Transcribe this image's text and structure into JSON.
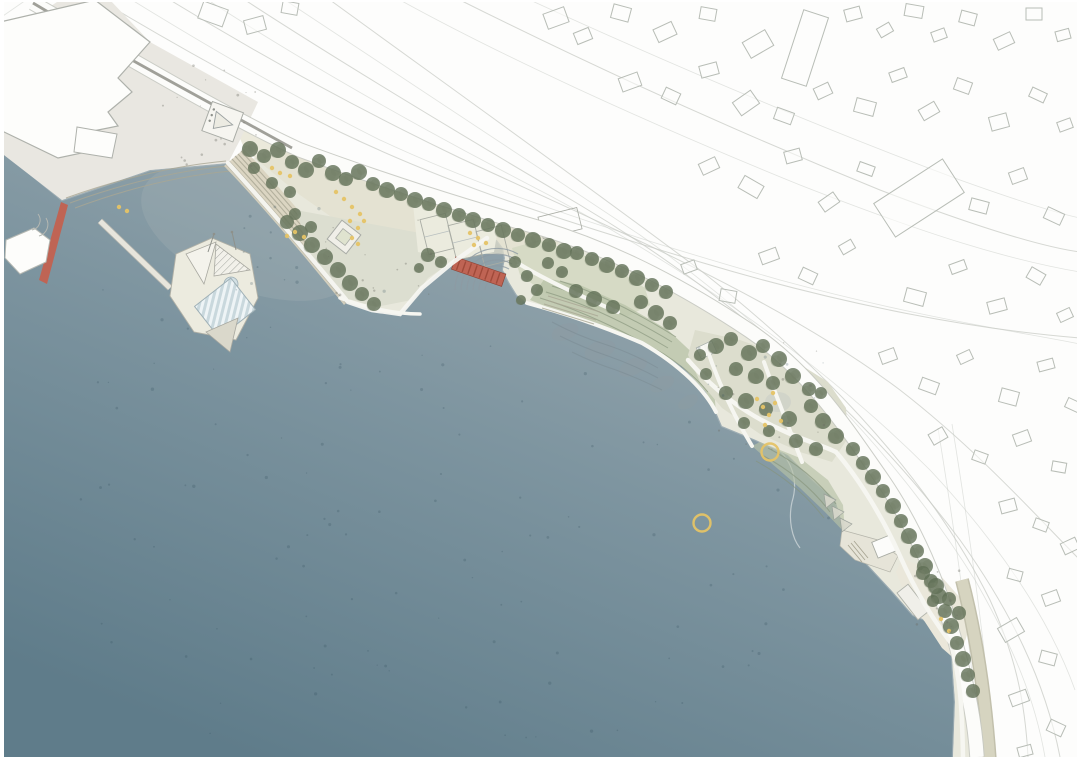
{
  "meta": {
    "type": "landscape masterplan site plan, aerial top-down rendering",
    "visible_text": "none",
    "scene": "harbor waterfront park with basin, floating harbor bath, red pedestrian pier and bridge, shoreline parks and existing town context"
  },
  "colors": {
    "water_light": "#9dabb1",
    "water_mid": "#7e95a0",
    "water_deep": "#5f7c8a",
    "land_base": "#e8e8dc",
    "wharf": "#e9e7e1",
    "promenade_tan": "#e2dfcd",
    "plaza": "#dcded0",
    "lawn": "#d6dac5",
    "slope_green": "#b7c1a6",
    "steps_tan": "#d9d3bf",
    "steps_line": "#a9a694",
    "tree_dark": "#5f6e55",
    "tree_mid": "#74816a",
    "sand": "#eae7da",
    "street_tan": "#cfcdb8",
    "path_white": "#f6f6f1",
    "road_white": "#fcfcfa",
    "road_edge": "#c6c9c2",
    "dark_road_line": "#96968e",
    "line_gray": "#c8cbc5",
    "building_stroke": "#b8bdb6",
    "accent_red": "#bf6454",
    "accent_red_dark": "#a04a3a",
    "accent_yellow": "#e5c366",
    "wetland": "#8e9ba2",
    "pool_blue": "#d3e0e4",
    "deck_white": "#ecebdf"
  },
  "legend_semantics": {
    "water_area": "harbor / sea basin",
    "red_strip_left": "red pier gangway at wharf",
    "red_strip_center": "red pedestrian bridge over inlet channel",
    "green_blobs": "tree canopies",
    "yellow_rings": "swimming floats in water",
    "yellow_dots": "playground / activity markings",
    "outlined_rectangles": "existing context building footprints",
    "striped_rectangle": "floating harbor bath pool deck",
    "hatched_lines": "terraced steps to water"
  },
  "map": {
    "swim_rings": [
      [
        770,
        452
      ],
      [
        702,
        523
      ]
    ],
    "swim_ring_radius": 8.5,
    "trees": [
      [
        250,
        149,
        8
      ],
      [
        264,
        156,
        7
      ],
      [
        278,
        150,
        8
      ],
      [
        292,
        162,
        7
      ],
      [
        306,
        170,
        8
      ],
      [
        319,
        161,
        7
      ],
      [
        333,
        173,
        8
      ],
      [
        346,
        179,
        7
      ],
      [
        359,
        172,
        8
      ],
      [
        373,
        184,
        7
      ],
      [
        387,
        190,
        8
      ],
      [
        401,
        194,
        7
      ],
      [
        415,
        200,
        8
      ],
      [
        429,
        204,
        7
      ],
      [
        444,
        210,
        8
      ],
      [
        459,
        215,
        7
      ],
      [
        473,
        220,
        8
      ],
      [
        488,
        225,
        7
      ],
      [
        503,
        230,
        8
      ],
      [
        518,
        235,
        7
      ],
      [
        533,
        240,
        8
      ],
      [
        549,
        245,
        7
      ],
      [
        564,
        251,
        8
      ],
      [
        272,
        183,
        6
      ],
      [
        254,
        168,
        6
      ],
      [
        290,
        192,
        6
      ],
      [
        287,
        222,
        7
      ],
      [
        300,
        233,
        8
      ],
      [
        312,
        245,
        8
      ],
      [
        325,
        257,
        8
      ],
      [
        338,
        270,
        8
      ],
      [
        350,
        283,
        8
      ],
      [
        362,
        294,
        7
      ],
      [
        374,
        304,
        7
      ],
      [
        295,
        214,
        6
      ],
      [
        311,
        227,
        6
      ],
      [
        428,
        255,
        7
      ],
      [
        441,
        262,
        6
      ],
      [
        419,
        268,
        5
      ],
      [
        515,
        262,
        6
      ],
      [
        527,
        276,
        6
      ],
      [
        537,
        290,
        6
      ],
      [
        521,
        300,
        5
      ],
      [
        577,
        253,
        7
      ],
      [
        592,
        259,
        7
      ],
      [
        607,
        265,
        8
      ],
      [
        622,
        271,
        7
      ],
      [
        637,
        278,
        8
      ],
      [
        652,
        285,
        7
      ],
      [
        666,
        292,
        7
      ],
      [
        576,
        291,
        7
      ],
      [
        594,
        299,
        8
      ],
      [
        613,
        307,
        7
      ],
      [
        562,
        272,
        6
      ],
      [
        548,
        263,
        6
      ],
      [
        641,
        302,
        7
      ],
      [
        656,
        313,
        8
      ],
      [
        670,
        323,
        7
      ],
      [
        716,
        346,
        8
      ],
      [
        731,
        339,
        7
      ],
      [
        749,
        353,
        8
      ],
      [
        763,
        346,
        7
      ],
      [
        779,
        359,
        8
      ],
      [
        736,
        369,
        7
      ],
      [
        756,
        376,
        8
      ],
      [
        773,
        383,
        7
      ],
      [
        793,
        376,
        8
      ],
      [
        809,
        389,
        7
      ],
      [
        726,
        393,
        7
      ],
      [
        746,
        401,
        8
      ],
      [
        766,
        409,
        7
      ],
      [
        789,
        419,
        8
      ],
      [
        811,
        406,
        7
      ],
      [
        823,
        421,
        8
      ],
      [
        836,
        436,
        8
      ],
      [
        816,
        449,
        7
      ],
      [
        796,
        441,
        7
      ],
      [
        769,
        431,
        6
      ],
      [
        744,
        423,
        6
      ],
      [
        821,
        393,
        6
      ],
      [
        700,
        355,
        6
      ],
      [
        706,
        374,
        6
      ],
      [
        853,
        449,
        7
      ],
      [
        863,
        463,
        7
      ],
      [
        873,
        477,
        8
      ],
      [
        883,
        491,
        7
      ],
      [
        893,
        506,
        8
      ],
      [
        901,
        521,
        7
      ],
      [
        909,
        536,
        8
      ],
      [
        917,
        551,
        7
      ],
      [
        925,
        566,
        8
      ],
      [
        931,
        581,
        7
      ],
      [
        939,
        596,
        8
      ],
      [
        945,
        611,
        7
      ],
      [
        951,
        626,
        8
      ],
      [
        957,
        643,
        7
      ],
      [
        963,
        659,
        8
      ],
      [
        968,
        675,
        7
      ],
      [
        973,
        691,
        7
      ],
      [
        923,
        573,
        7
      ],
      [
        936,
        586,
        8
      ],
      [
        949,
        599,
        7
      ],
      [
        959,
        613,
        7
      ],
      [
        933,
        601,
        6
      ]
    ],
    "context_buildings": [
      [
        545,
        10,
        22,
        16,
        -20
      ],
      [
        575,
        30,
        16,
        12,
        -22
      ],
      [
        612,
        6,
        18,
        14,
        15
      ],
      [
        655,
        25,
        20,
        14,
        -25
      ],
      [
        700,
        8,
        16,
        12,
        10
      ],
      [
        745,
        35,
        26,
        18,
        -30
      ],
      [
        792,
        12,
        26,
        72,
        18
      ],
      [
        845,
        8,
        16,
        12,
        -15
      ],
      [
        878,
        25,
        14,
        10,
        -30
      ],
      [
        905,
        5,
        18,
        12,
        10
      ],
      [
        932,
        30,
        14,
        10,
        -20
      ],
      [
        960,
        12,
        16,
        12,
        15
      ],
      [
        995,
        35,
        18,
        12,
        -25
      ],
      [
        1026,
        8,
        16,
        12,
        0
      ],
      [
        1056,
        30,
        14,
        10,
        -15
      ],
      [
        620,
        75,
        20,
        14,
        -20
      ],
      [
        663,
        90,
        16,
        12,
        25
      ],
      [
        700,
        64,
        18,
        12,
        -15
      ],
      [
        735,
        95,
        22,
        16,
        -35
      ],
      [
        775,
        110,
        18,
        12,
        20
      ],
      [
        815,
        85,
        16,
        12,
        -25
      ],
      [
        855,
        100,
        20,
        14,
        15
      ],
      [
        890,
        70,
        16,
        10,
        -20
      ],
      [
        920,
        105,
        18,
        12,
        -30
      ],
      [
        955,
        80,
        16,
        12,
        20
      ],
      [
        990,
        115,
        18,
        14,
        -15
      ],
      [
        1030,
        90,
        16,
        10,
        25
      ],
      [
        1058,
        120,
        14,
        10,
        -20
      ],
      [
        700,
        160,
        18,
        12,
        -25
      ],
      [
        740,
        180,
        22,
        14,
        30
      ],
      [
        785,
        150,
        16,
        12,
        -15
      ],
      [
        820,
        196,
        18,
        12,
        -35
      ],
      [
        858,
        164,
        16,
        10,
        20
      ],
      [
        878,
        178,
        82,
        40,
        -33
      ],
      [
        970,
        200,
        18,
        12,
        15
      ],
      [
        1010,
        170,
        16,
        12,
        -20
      ],
      [
        1045,
        210,
        18,
        12,
        25
      ],
      [
        760,
        250,
        18,
        12,
        -20
      ],
      [
        800,
        270,
        16,
        12,
        25
      ],
      [
        840,
        242,
        14,
        10,
        -30
      ],
      [
        905,
        290,
        20,
        14,
        15
      ],
      [
        950,
        262,
        16,
        10,
        -20
      ],
      [
        988,
        300,
        18,
        12,
        -15
      ],
      [
        1028,
        270,
        16,
        12,
        30
      ],
      [
        1058,
        310,
        14,
        10,
        -25
      ],
      [
        720,
        290,
        16,
        12,
        10
      ],
      [
        682,
        262,
        14,
        10,
        -20
      ],
      [
        880,
        350,
        16,
        12,
        -20
      ],
      [
        920,
        380,
        18,
        12,
        20
      ],
      [
        958,
        352,
        14,
        10,
        -25
      ],
      [
        1000,
        390,
        18,
        14,
        15
      ],
      [
        1038,
        360,
        16,
        10,
        -15
      ],
      [
        1066,
        400,
        14,
        10,
        25
      ],
      [
        930,
        430,
        16,
        12,
        -30
      ],
      [
        973,
        452,
        14,
        10,
        20
      ],
      [
        1014,
        432,
        16,
        12,
        -20
      ],
      [
        1052,
        462,
        14,
        10,
        10
      ],
      [
        1000,
        500,
        16,
        12,
        -15
      ],
      [
        1034,
        520,
        14,
        10,
        20
      ],
      [
        1062,
        540,
        16,
        12,
        -25
      ],
      [
        1008,
        570,
        14,
        10,
        15
      ],
      [
        1043,
        592,
        16,
        12,
        -20
      ],
      [
        1000,
        622,
        22,
        16,
        -30
      ],
      [
        1040,
        652,
        16,
        12,
        15
      ],
      [
        1010,
        692,
        18,
        12,
        -20
      ],
      [
        1048,
        722,
        16,
        12,
        25
      ],
      [
        1018,
        746,
        14,
        10,
        -15
      ],
      [
        200,
        5,
        26,
        18,
        20
      ],
      [
        245,
        18,
        20,
        14,
        -15
      ],
      [
        282,
        2,
        16,
        12,
        10
      ],
      [
        962,
        694,
        16,
        26,
        -6
      ],
      [
        968,
        740,
        20,
        13,
        -4
      ]
    ],
    "playground_dots": [
      [
        272,
        168
      ],
      [
        280,
        173
      ],
      [
        290,
        176
      ],
      [
        336,
        192
      ],
      [
        344,
        199
      ],
      [
        352,
        207
      ],
      [
        360,
        214
      ],
      [
        350,
        221
      ],
      [
        358,
        228
      ],
      [
        364,
        221
      ],
      [
        352,
        238
      ],
      [
        358,
        244
      ],
      [
        295,
        232
      ],
      [
        304,
        237
      ],
      [
        287,
        236
      ],
      [
        470,
        233
      ],
      [
        478,
        238
      ],
      [
        486,
        243
      ],
      [
        474,
        245
      ],
      [
        119,
        207
      ],
      [
        127,
        211
      ],
      [
        757,
        399
      ],
      [
        763,
        407
      ],
      [
        769,
        415
      ],
      [
        775,
        403
      ],
      [
        781,
        421
      ],
      [
        765,
        425
      ],
      [
        773,
        393
      ],
      [
        941,
        619
      ],
      [
        949,
        631
      ]
    ],
    "water_speckle_zones": [
      [
        80,
        280,
        320,
        380,
        50
      ],
      [
        420,
        340,
        420,
        340,
        45
      ],
      [
        120,
        640,
        650,
        100,
        25
      ],
      [
        240,
        200,
        90,
        90,
        12
      ]
    ],
    "land_speckle_zones": [
      [
        150,
        60,
        110,
        110,
        20
      ],
      [
        300,
        220,
        140,
        80,
        16
      ],
      [
        905,
        570,
        60,
        80,
        10
      ],
      [
        700,
        340,
        130,
        110,
        14
      ]
    ]
  }
}
